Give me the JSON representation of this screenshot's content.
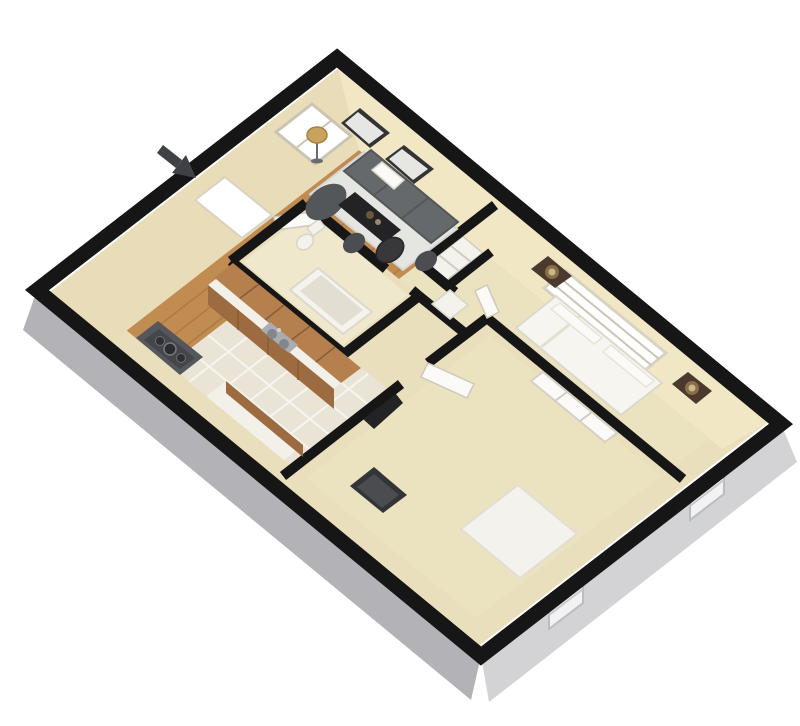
{
  "palette": {
    "background": "#ffffff",
    "wall": "#161616",
    "bandLeft": "#b3b3b7",
    "bandRight": "#d3d3d6",
    "bandWindow": "#f2f2f3",
    "bandWindowFrame": "#b9bcc0",
    "faceTopLeft": "#e9dcb8",
    "faceTopRight": "#f2e7c4",
    "floorBase": "#e9dfbd",
    "wood": "#c18c52",
    "plank": "#a9763f",
    "tile": "#eae4d6",
    "grout": "#f7f5ef",
    "carpet": "#ebe2bf",
    "bathFloor": "#efe8cc",
    "whiteItem": "#f4f2ec",
    "trimGray": "#cfcbc0",
    "sofa": "#66696c",
    "sofaDark": "#54575a",
    "rug": "#e5e5e2",
    "rugEdge": "#d6d6d2",
    "darkFurniture": "#232326",
    "chair": "#4b4d50",
    "gold": "#c9a25e",
    "goldDark": "#a5803f",
    "cabinet": "#b5804e",
    "cabinetFront": "#9c6b40",
    "cabinetLine": "#8a5c36",
    "counter": "#f3f0e9",
    "steel": "#a9adb2",
    "steelDark": "#83878c",
    "stove": "#55575c",
    "stoveInset": "#44464b",
    "bedWhite": "#f7f5ef",
    "bedLine": "#e3dfd3",
    "linen": "#fbfaf6",
    "nightstand": "#4a392c",
    "tub": "#f5f3ee",
    "tubInner": "#e3ded2",
    "windowGlass": "#ffffff",
    "windowFrame": "#d8d2c2",
    "windowSlat": "#c9c4b4",
    "arrow": "#3f4145"
  }
}
